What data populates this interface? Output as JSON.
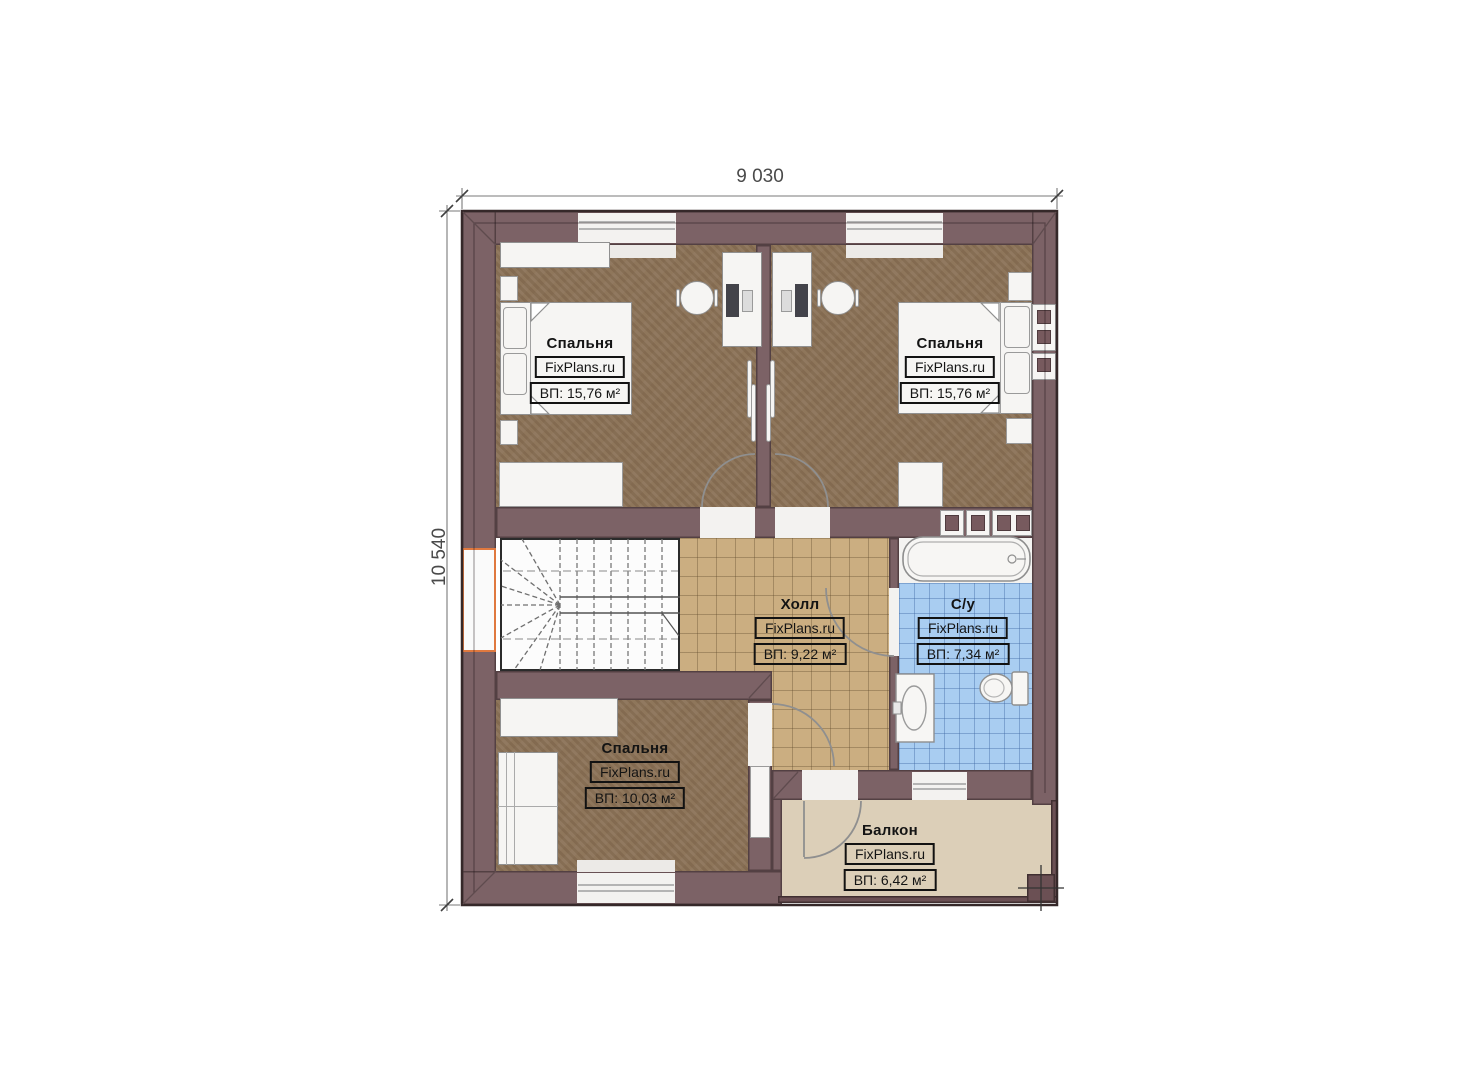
{
  "dimensions": {
    "top": "9 030",
    "left": "10 540"
  },
  "watermark": "FixPlans.ru",
  "rooms": [
    {
      "key": "bedroom-top-left",
      "name": "Спальня",
      "area": "ВП: 15,76 м²"
    },
    {
      "key": "bedroom-top-right",
      "name": "Спальня",
      "area": "ВП: 15,76 м²"
    },
    {
      "key": "hall",
      "name": "Холл",
      "area": "ВП: 9,22 м²"
    },
    {
      "key": "bathroom",
      "name": "С/у",
      "area": "ВП: 7,34 м²"
    },
    {
      "key": "bedroom-bottom",
      "name": "Спальня",
      "area": "ВП: 10,03 м²"
    },
    {
      "key": "balcony",
      "name": "Балкон",
      "area": "ВП: 6,42 м²"
    }
  ],
  "colors": {
    "wall": "#7c6266",
    "bedroom_floor": "#8d7459",
    "hall_floor": "#cbae81",
    "bathroom_floor": "#a9cdf1",
    "balcony_floor": "#dccfb8",
    "stair_floor": "#fcfcfc",
    "window_accent": "#e0793f"
  }
}
